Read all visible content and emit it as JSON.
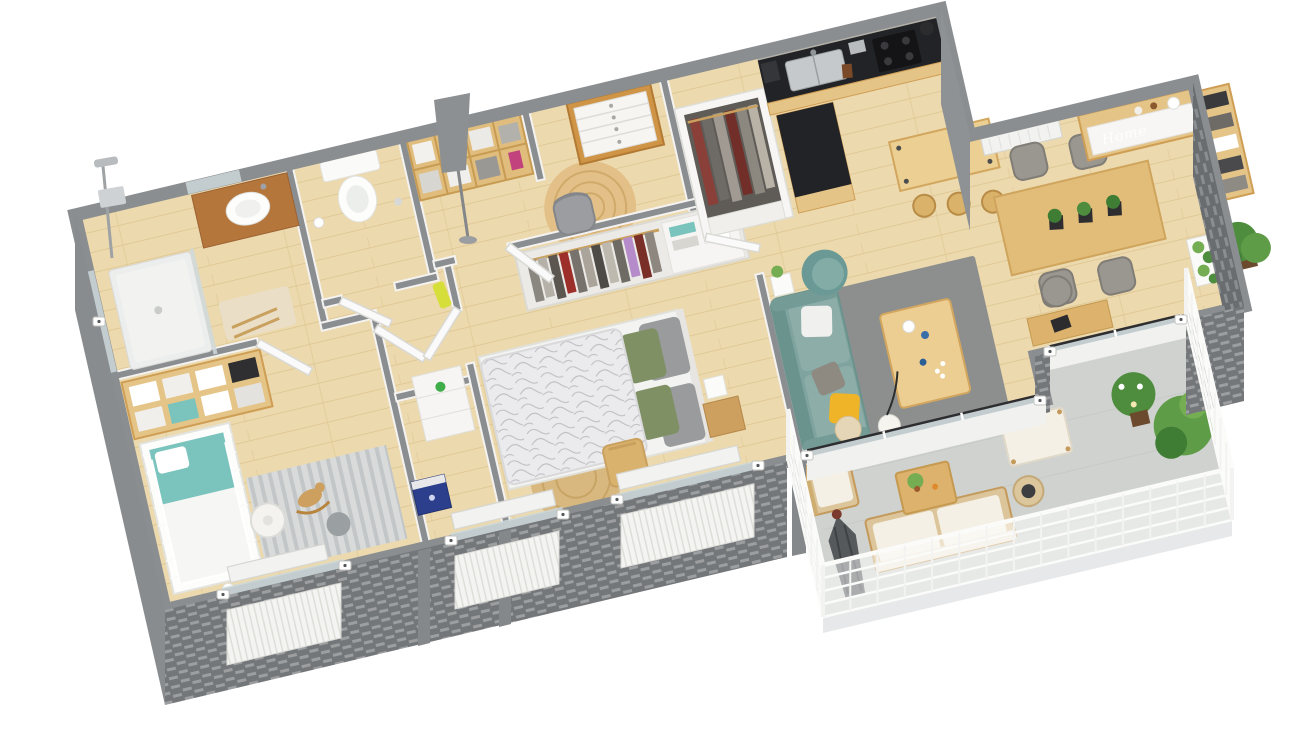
{
  "scene": {
    "title": "3D apartment floor plan render",
    "view": "isometric top-down 3D floor plan on white background",
    "background": "#ffffff",
    "decor_text": {
      "home_sign": "Home"
    },
    "palette": {
      "floor": "#ecd9ad",
      "floor_line": "#dcc48f",
      "balcony_floor": "#cfd2cf",
      "wall_top": "#8b8e90",
      "wall_face": "#f4f3f1",
      "brick": "#74777a",
      "brick_line": "#a3a5a7",
      "glass": "#ccd8dc",
      "door_white": "#fbfafa",
      "sofa_teal": "#7fa39e",
      "sofa_teal_dark": "#6b938e",
      "pillow_yellow": "#f0b429",
      "pillow_green": "#7e9064",
      "pillow_gray": "#8e8a82",
      "wood_light": "#e5c487",
      "wood_mid": "#cf9e55",
      "wood_dark": "#b5763c",
      "counter_black": "#222326",
      "steel": "#c6c9cb",
      "rug_gray": "#8d8f8e",
      "rug_jute": "#d9b880",
      "crib_teal": "#7ac4bd",
      "chair_gray": "#9a9690",
      "plant_green": "#4e8d3e",
      "plant_light": "#74ad52",
      "parasol_gray": "#56595c",
      "rail_white": "#fbfbfa",
      "radiator_white": "#f2f2f0",
      "toybox_blue": "#2b3f8c",
      "robe_yellow": "#d6df3a"
    },
    "rooms": [
      {
        "id": "bathroom",
        "name": "Bathroom",
        "furniture": [
          "walk-in shower",
          "shower column",
          "wood vanity with vessel sink",
          "bath mat",
          "towel ladder"
        ]
      },
      {
        "id": "wc",
        "name": "WC",
        "furniture": [
          "wall-hung toilet",
          "toilet paper holder"
        ]
      },
      {
        "id": "hall-office",
        "name": "Hallway / office nook",
        "furniture": [
          "bookshelf",
          "chest of drawers",
          "gray floor lamp",
          "desk chair",
          "round jute rug",
          "yellow robe on hook"
        ]
      },
      {
        "id": "nursery",
        "name": "Nursery",
        "furniture": [
          "white crib with teal bedding",
          "cubby shelving unit",
          "white floor lamp",
          "striped rug",
          "rocking horse",
          "blue toy box",
          "white dresser",
          "green toy car",
          "plush bunny"
        ]
      },
      {
        "id": "bedroom",
        "name": "Bedroom",
        "furniture": [
          "double bed with patterned duvet",
          "open wardrobe with hanging clothes",
          "wooden chair",
          "nightstand",
          "cube lamp",
          "round jute rug"
        ]
      },
      {
        "id": "kitchen",
        "name": "Kitchen",
        "furniture": [
          "black countertop with sink and hob",
          "mosaic backsplash",
          "kitchen island",
          "bar table",
          "3 bar stools",
          "entry closet with hanging clothes"
        ]
      },
      {
        "id": "living-room",
        "name": "Living room",
        "furniture": [
          "teal sofa with pillows",
          "teal armchair",
          "wooden coffee table",
          "gray rug",
          "ball floor lamp",
          "beige pouf",
          "white side cube"
        ]
      },
      {
        "id": "dining-area",
        "name": "Dining area",
        "furniture": [
          "dining table with black X legs",
          "4 gray chairs",
          "3 black table planters",
          "sideboard with Home sign",
          "tall bookcase",
          "corner plant",
          "white planter trough",
          "desk with chair",
          "wall radiator"
        ]
      },
      {
        "id": "balcony",
        "name": "Balcony / terrace",
        "furniture": [
          "outdoor armchair",
          "outdoor sofa with white cushions",
          "closed gray parasol",
          "wooden coffee table with plant",
          "ottoman",
          "rattan pouf",
          "potted plants",
          "white railing"
        ]
      }
    ],
    "openings": {
      "windows": 5,
      "sliding_glass_doors": 2,
      "interior_doors": 6,
      "wall_tag_count": 11
    }
  }
}
